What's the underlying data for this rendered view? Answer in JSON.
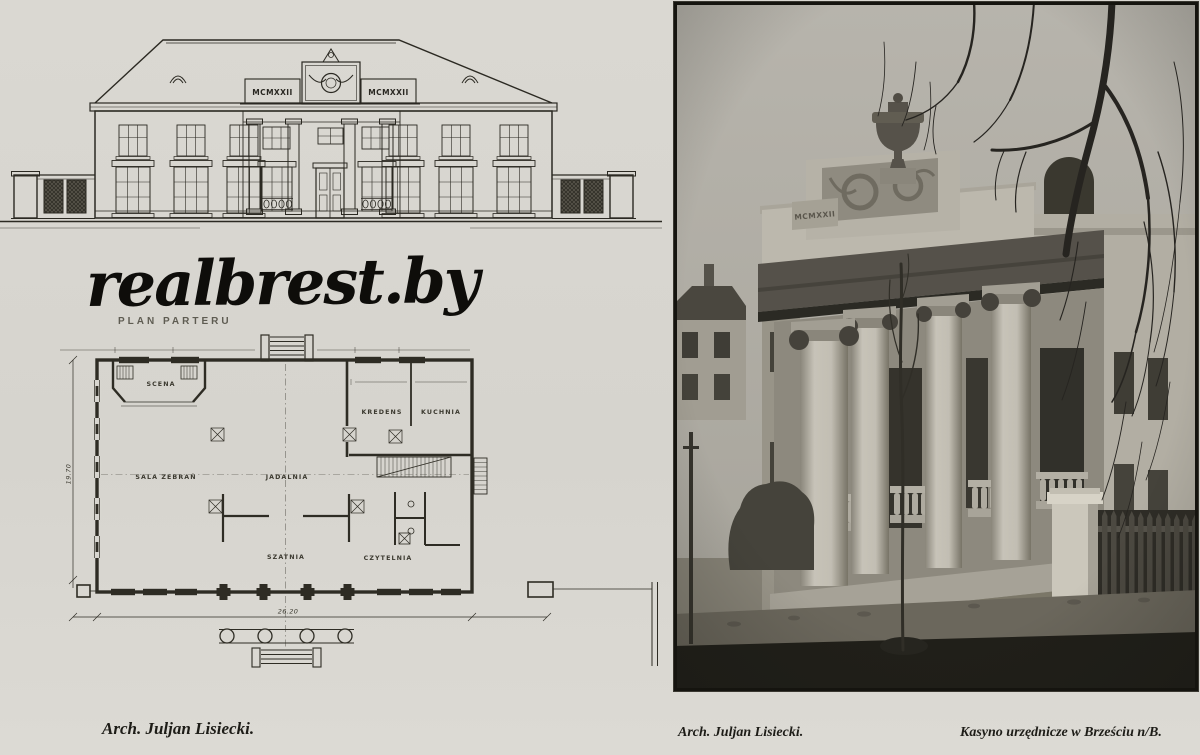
{
  "left_page": {
    "elevation": {
      "inscription_left": "MCMXXII",
      "inscription_right": "MCMXXII"
    },
    "watermark": "realbrest.by",
    "floor_plan": {
      "title": "PLAN PARTERU",
      "rooms": {
        "scena": "SCENA",
        "sala_zebran": "SALA ZEBRAŃ",
        "jadalnia": "JADALNIA",
        "kredens": "KREDENS",
        "kuchnia": "KUCHNIA",
        "szatnia": "SZATNIA",
        "czytelnia": "CZYTELNIA"
      },
      "dim_width": "26.20",
      "dim_depth": "19.70"
    },
    "caption": "Arch. Juljan Lisiecki."
  },
  "photo_page": {
    "attic_inscription": "MCMXXII",
    "caption_architect": "Arch. Juljan Lisiecki.",
    "caption_title": "Kasyno urzędnicze w Brześciu n/B."
  },
  "colors": {
    "paper": "#d8d6d0",
    "ink": "#2b2922",
    "photo_shadow": "#201f19"
  }
}
